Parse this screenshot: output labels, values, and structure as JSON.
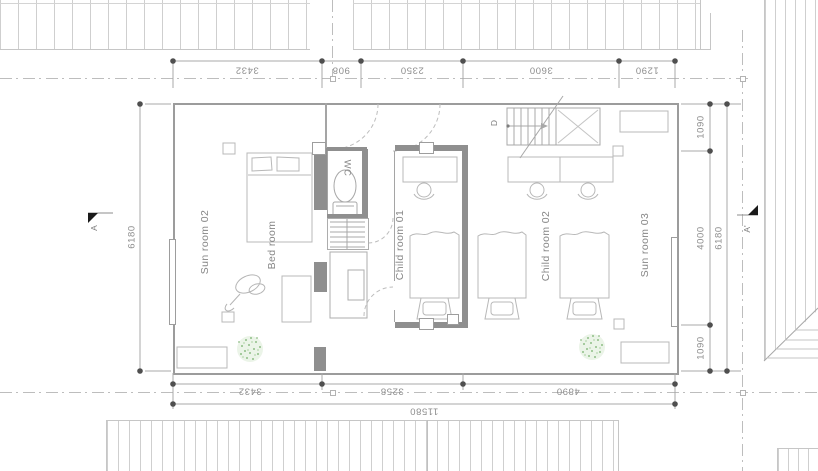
{
  "plan": {
    "rooms": [
      {
        "label": "Sun room 02"
      },
      {
        "label": "Bed room"
      },
      {
        "label": "Child room 01"
      },
      {
        "label": "Child room 02"
      },
      {
        "label": "Sun room 03"
      },
      {
        "label": "WC"
      }
    ],
    "stair": {
      "label": "D"
    },
    "sections": {
      "left": "A",
      "right": "A'"
    },
    "dims": {
      "top": [
        "3432",
        "908",
        "2350",
        "3600",
        "1290"
      ],
      "bottom_segments": [
        "3432",
        "3258",
        "4890"
      ],
      "bottom_total": "11580",
      "left_total": "6180",
      "right_segments": [
        "1090",
        "4000",
        "1090"
      ],
      "right_total": "6180"
    },
    "colors": {
      "line": "#a8a8a8",
      "wall": "#8f8f8f",
      "dot": "#4f4f4f",
      "text": "#8a8a8a",
      "plant": "#8fbd86",
      "hatch": "#cfcfcf"
    }
  }
}
